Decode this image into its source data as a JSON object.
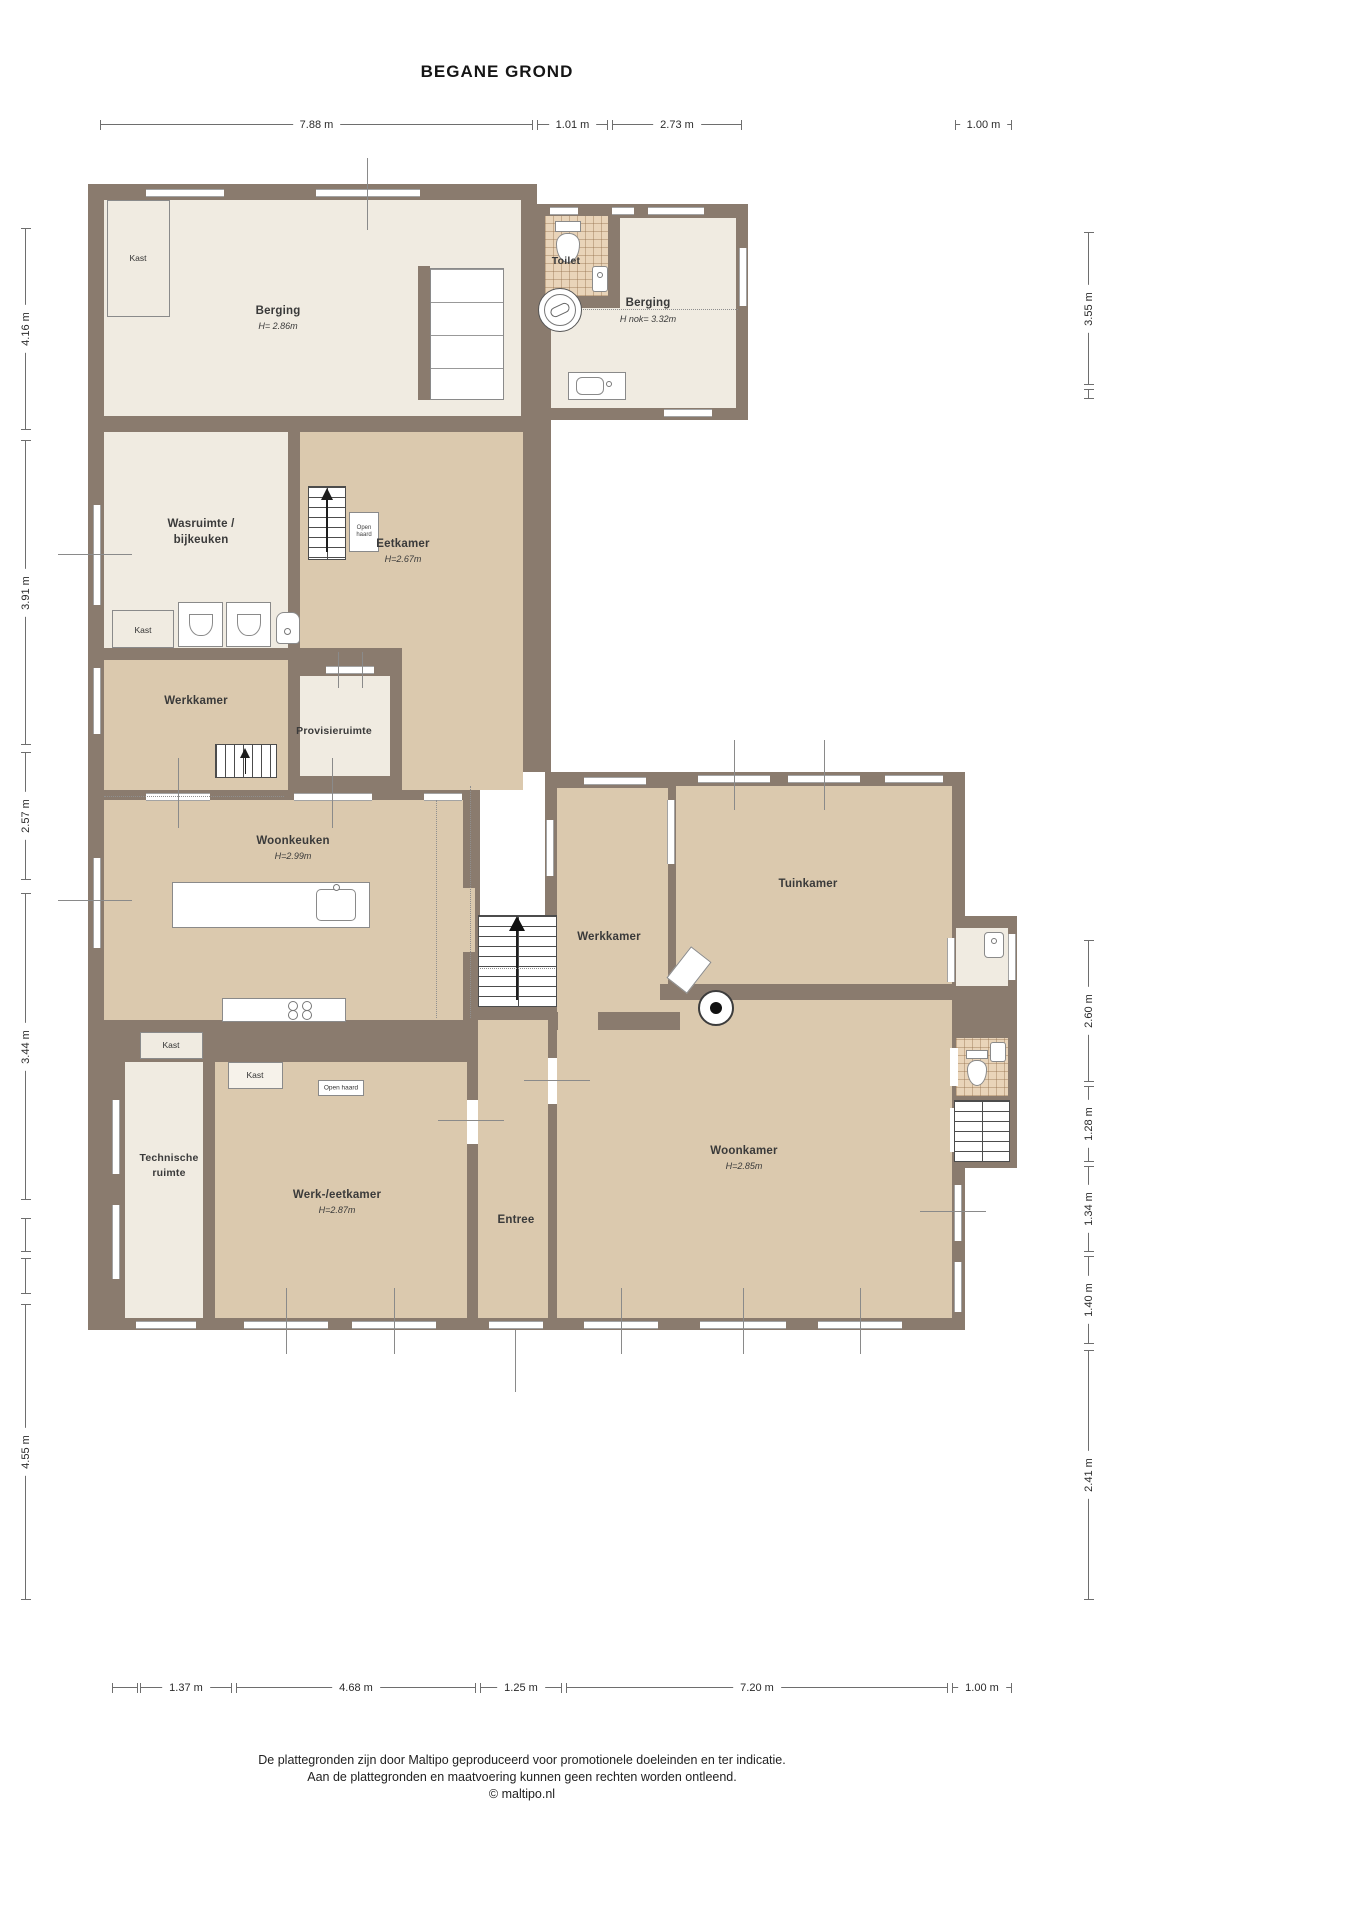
{
  "title": "BEGANE GROND",
  "colors": {
    "wall": "#8a7b6e",
    "floor_light": "#f0ebe1",
    "floor_tan": "#dbc9ae",
    "floor_tile": "#e9d4b9",
    "dimension_line": "#6e6e6e"
  },
  "dims": {
    "top": [
      "7.88 m",
      "1.01 m",
      "2.73 m",
      "1.00 m"
    ],
    "left": [
      "4.16 m",
      "3.91 m",
      "2.57 m",
      "3.44 m",
      "4.55 m"
    ],
    "right": [
      "3.55 m",
      "2.60 m",
      "1.28 m",
      "1.34 m",
      "1.40 m",
      "2.41 m"
    ],
    "bottom": [
      "1.37 m",
      "4.68 m",
      "1.25 m",
      "7.20 m",
      "1.00 m"
    ]
  },
  "rooms": {
    "berging_left": {
      "name": "Berging",
      "height": "H= 2.86m"
    },
    "toilet": {
      "name": "Toilet"
    },
    "berging_right": {
      "name": "Berging",
      "height": "H nok= 3.32m"
    },
    "wasruimte": {
      "line1": "Wasruimte /",
      "line2": "bijkeuken"
    },
    "eetkamer": {
      "name": "Eetkamer",
      "height": "H=2.67m"
    },
    "werkkamer_left": {
      "name": "Werkkamer"
    },
    "provisieruimte": {
      "name": "Provisieruimte"
    },
    "woonkeuken": {
      "name": "Woonkeuken",
      "height": "H=2.99m"
    },
    "werkkamer_mid": {
      "name": "Werkkamer"
    },
    "tuinkamer": {
      "name": "Tuinkamer"
    },
    "technische": {
      "line1": "Technische",
      "line2": "ruimte"
    },
    "werk_eetkamer": {
      "name": "Werk-/eetkamer",
      "height": "H=2.87m"
    },
    "entree": {
      "name": "Entree"
    },
    "woonkamer": {
      "name": "Woonkamer",
      "height": "H=2.85m"
    }
  },
  "labels": {
    "kast": "Kast",
    "open_haard": "Open haard",
    "open": "Open",
    "haard": "haard"
  },
  "icons": {
    "fixtures": [
      "toilet-icon",
      "sink-icon",
      "washing-machine-icon",
      "stairs-up-icon",
      "stove-burners-icon",
      "wood-stove-icon",
      "kitchen-island-icon",
      "fireplace-icon",
      "shelf-icon"
    ]
  },
  "footer": {
    "line1": "De plattegronden zijn door Maltipo geproduceerd voor promotionele doeleinden en ter indicatie.",
    "line2": "Aan de plattegronden en maatvoering kunnen geen rechten worden ontleend.",
    "line3": "© maltipo.nl"
  }
}
